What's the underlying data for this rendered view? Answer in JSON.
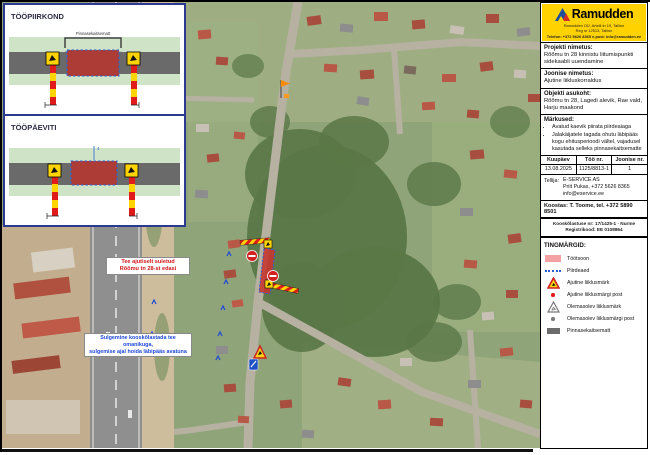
{
  "inset": {
    "drawing1": {
      "title": "TÖÖPIIRKOND",
      "bracket_label": "Pinnasekaitsematt"
    },
    "drawing2": {
      "title": "TÖÖPÄEVITI",
      "dim_label": "4"
    }
  },
  "map": {
    "callout_red": {
      "line1": "Tee ajutiselt suletud",
      "line2": "Rõõmu tn 28-st edasi"
    },
    "callout_blue": {
      "line1": "Sulgemine kooskõlastada tee omanikuga,",
      "line2": "sulgemise ajal hoida läbipääs avatuna"
    },
    "signs": [
      "roadwork-warning-sign",
      "no-entry-sign",
      "striped-barrier",
      "work-zone-area",
      "info-sign-blue",
      "flag-marker"
    ]
  },
  "panel": {
    "brand": {
      "name": "Ramudden",
      "address_lines": [
        "Ramudden OÜ, Artelli tn 19, Tallinn",
        "Reg nr 12513, Tallinn",
        "Telefon: +372 5626 8365  e-post: info@ramudden.ee"
      ]
    },
    "project": {
      "label": "Projekti nimetus:",
      "value": "Rõõmu tn 28 kinnistu liitumispunkti sidekaabli uuendamine"
    },
    "drawing": {
      "label": "Joonise nimetus:",
      "value": "Ajutine liikluskorraldus"
    },
    "location": {
      "label": "Objekti asukoht:",
      "value": "Rõõmu tn 28, Lagedi alevik, Rae vald, Harju maakond"
    },
    "notes": {
      "label": "Märkused:",
      "items": [
        "Avatud kaevik piirata piirdeaiaga",
        "Jalakäijatele tagada ohutu läbipääs kogu ehitusperioodi vältel, vajadusel kasutada selleks pinnasekaitsematte"
      ]
    },
    "meta": {
      "headers": [
        "Kuupäev",
        "Töö nr.",
        "Joonise nr."
      ],
      "values": [
        "13.08.2025",
        "1125/8813-1",
        "1"
      ]
    },
    "client": {
      "label": "Tellija:",
      "lines": [
        "E-SERVICE AS",
        "Priit Pukas, +372 5626 8365",
        "info@eservice.ee"
      ]
    },
    "author": "Koostas: T. Toome, tel. +372 5890 8501",
    "approval_lines": [
      "Kooskõlastuse nr: 17/1425-1 · Nurme",
      "Registrikood: EE 0108864"
    ],
    "legend": {
      "title": "TINGMÄRGID:",
      "items": [
        {
          "icon": "workzone-swatch",
          "label": "Töötsoon"
        },
        {
          "icon": "fence-dashed-line",
          "label": "Piirdeaed"
        },
        {
          "icon": "roadwork-sign-icon",
          "label": "Ajutine liiklusmärk"
        },
        {
          "icon": "red-post-dot",
          "label": "Ajutine liiklusmärgi post"
        },
        {
          "icon": "existing-sign-icon",
          "label": "Olemasolev liiklusmärk"
        },
        {
          "icon": "gray-post-dot",
          "label": "Olemasolev liiklusmärgi post"
        },
        {
          "icon": "ground-mat-swatch",
          "label": "Pinnasekaitsematt"
        }
      ]
    }
  },
  "colors": {
    "brand_yellow": "#FFD200",
    "workzone_red": "#c43a32",
    "fence_blue": "#2b5fd9",
    "legend_pink": "#f2a2a2"
  }
}
